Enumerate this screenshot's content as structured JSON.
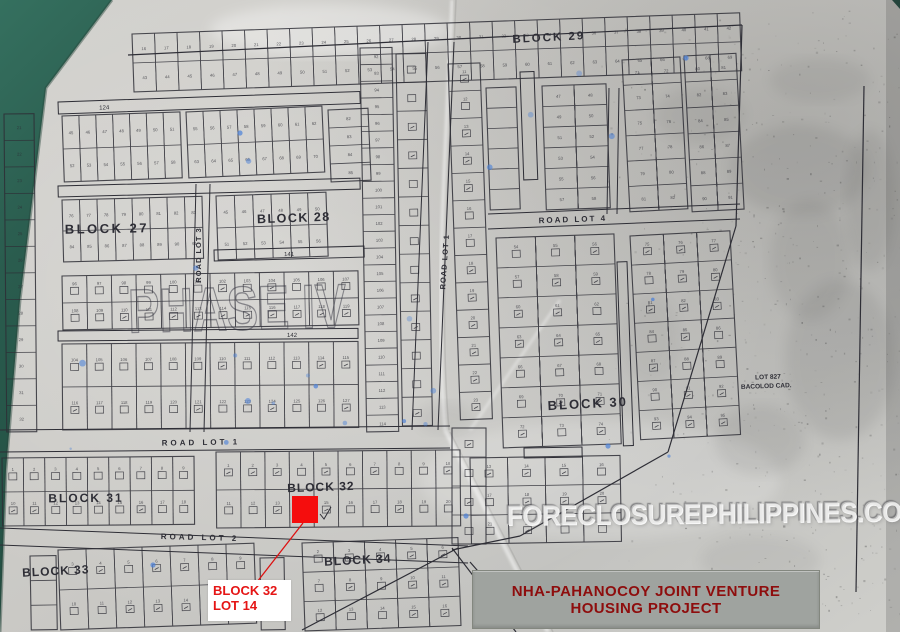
{
  "title_box": {
    "line1": "NHA-PAHANOCOY JOINT VENTURE",
    "line2": "HOUSING PROJECT"
  },
  "highlight_callout": {
    "line1": "BLOCK 32",
    "line2": "LOT 14"
  },
  "watermarks": {
    "site": "FORECLOSUREPHILIPPINES.COM",
    "phase": "PHASE IV"
  },
  "colors": {
    "background_cloth": "#235447",
    "paper": "#cccbc7",
    "ink": "#2e2e36",
    "highlight_red": "#f50d0d",
    "callout_red": "#e51515",
    "title_red": "#8e0d0d",
    "title_bg": "#9fa39f",
    "stain_blue": "#4a80d8"
  },
  "plat": {
    "block_labels": [
      {
        "text": "BLOCK 29",
        "x": 549,
        "y": 41,
        "size": 11.5,
        "rot": -3,
        "ls": 2
      },
      {
        "text": "BLOCK 27",
        "x": 107,
        "y": 233,
        "size": 13,
        "rot": -1,
        "ls": 2.5
      },
      {
        "text": "BLOCK 28",
        "x": 294,
        "y": 222,
        "size": 12.5,
        "rot": -2,
        "ls": 1.5
      },
      {
        "text": "BLOCK 30",
        "x": 588,
        "y": 408,
        "size": 13,
        "rot": -3,
        "ls": 2
      },
      {
        "text": "BLOCK 31",
        "x": 86,
        "y": 502,
        "size": 12,
        "rot": -0.5,
        "ls": 2
      },
      {
        "text": "BLOCK 32",
        "x": 321,
        "y": 491,
        "size": 12,
        "rot": -2,
        "ls": 1
      },
      {
        "text": "BLOCK 33",
        "x": 56,
        "y": 575,
        "size": 12,
        "rot": -3,
        "ls": 1
      },
      {
        "text": "BLOCK 34",
        "x": 358,
        "y": 564,
        "size": 12,
        "rot": -3,
        "ls": 1
      }
    ],
    "road_labels": [
      {
        "text": "ROAD LOT 3",
        "x": 201,
        "y": 255,
        "size": 7.5,
        "rot": -90,
        "ls": 1
      },
      {
        "text": "ROAD LOT 1",
        "x": 447,
        "y": 262,
        "size": 7.5,
        "rot": -86,
        "ls": 1
      },
      {
        "text": "ROAD LOT 4",
        "x": 573,
        "y": 222,
        "size": 8,
        "rot": -2,
        "ls": 2
      },
      {
        "text": "ROAD LOT 1",
        "x": 201,
        "y": 445,
        "size": 8,
        "rot": -1,
        "ls": 3
      },
      {
        "text": "ROAD LOT 2",
        "x": 200,
        "y": 540,
        "size": 8,
        "rot": 1.5,
        "ls": 3
      }
    ],
    "landmark": {
      "line1": "LOT 827",
      "line2": "BACOLOD CAD.",
      "x": 768,
      "y": 379
    },
    "grids": [
      {
        "x": 132,
        "y": 34,
        "w": 608,
        "h": 58,
        "rows": 2,
        "cols": 27,
        "rot": -2,
        "start": 16
      },
      {
        "x": 4,
        "y": 114,
        "w": 30,
        "h": 318,
        "rows": 12,
        "cols": 1,
        "rot": -0.5,
        "start": 21
      },
      {
        "x": 62,
        "y": 116,
        "w": 118,
        "h": 66,
        "rows": 2,
        "cols": 7,
        "rot": -2,
        "start": 45
      },
      {
        "x": 186,
        "y": 112,
        "w": 136,
        "h": 66,
        "rows": 2,
        "cols": 8,
        "rot": -2.5,
        "start": 55
      },
      {
        "x": 328,
        "y": 110,
        "w": 40,
        "h": 72,
        "rows": 4,
        "cols": 1,
        "rot": -2.5,
        "start": 82
      },
      {
        "x": 62,
        "y": 200,
        "w": 140,
        "h": 62,
        "rows": 2,
        "cols": 8,
        "rot": -1.5,
        "start": 76
      },
      {
        "x": 216,
        "y": 196,
        "w": 110,
        "h": 64,
        "rows": 2,
        "cols": 6,
        "rot": -2,
        "start": 45
      },
      {
        "x": 360,
        "y": 48,
        "w": 32,
        "h": 384,
        "rows": 23,
        "cols": 1,
        "rot": -1,
        "start": 92
      },
      {
        "x": 396,
        "y": 54,
        "w": 30,
        "h": 372,
        "rows": 13,
        "cols": 1,
        "rot": -1,
        "sym": true
      },
      {
        "x": 62,
        "y": 276,
        "w": 296,
        "h": 54,
        "rows": 2,
        "cols": 12,
        "rot": -1,
        "start": 96,
        "sym": true
      },
      {
        "x": 62,
        "y": 344,
        "w": 296,
        "h": 86,
        "rows": 2,
        "cols": 12,
        "rot": -0.5,
        "start": 104,
        "sym": true
      },
      {
        "x": 448,
        "y": 64,
        "w": 32,
        "h": 356,
        "rows": 13,
        "cols": 1,
        "rot": -2,
        "start": 11,
        "sym": true
      },
      {
        "x": 452,
        "y": 428,
        "w": 34,
        "h": 116,
        "rows": 4,
        "cols": 1,
        "rot": 0,
        "sym": true
      },
      {
        "x": 486,
        "y": 88,
        "w": 30,
        "h": 122,
        "rows": 6,
        "cols": 1,
        "rot": -2
      },
      {
        "x": 542,
        "y": 86,
        "w": 64,
        "h": 124,
        "rows": 6,
        "cols": 2,
        "rot": -2,
        "start": 47
      },
      {
        "x": 622,
        "y": 60,
        "w": 58,
        "h": 152,
        "rows": 6,
        "cols": 2,
        "rot": -3,
        "start": 71
      },
      {
        "x": 684,
        "y": 56,
        "w": 52,
        "h": 156,
        "rows": 6,
        "cols": 2,
        "rot": -3,
        "start": 80
      },
      {
        "x": 496,
        "y": 238,
        "w": 118,
        "h": 210,
        "rows": 7,
        "cols": 3,
        "rot": -2,
        "start": 54,
        "sym": true
      },
      {
        "x": 630,
        "y": 236,
        "w": 100,
        "h": 204,
        "rows": 7,
        "cols": 3,
        "rot": -3,
        "start": 75,
        "sym": true
      },
      {
        "x": 470,
        "y": 458,
        "w": 150,
        "h": 86,
        "rows": 3,
        "cols": 4,
        "rot": -1,
        "start": 13,
        "sym": true
      },
      {
        "x": 2,
        "y": 458,
        "w": 192,
        "h": 68,
        "rows": 2,
        "cols": 9,
        "rot": -0.5,
        "start": 1,
        "sym": true
      },
      {
        "x": 216,
        "y": 452,
        "w": 244,
        "h": 76,
        "rows": 2,
        "cols": 10,
        "rot": -0.5,
        "start": 1,
        "sym": true
      },
      {
        "x": 30,
        "y": 556,
        "w": 26,
        "h": 74,
        "rows": 3,
        "cols": 1,
        "rot": -1
      },
      {
        "x": 58,
        "y": 550,
        "w": 196,
        "h": 80,
        "rows": 2,
        "cols": 7,
        "rot": -2,
        "start": 3,
        "sym": true
      },
      {
        "x": 260,
        "y": 558,
        "w": 24,
        "h": 72,
        "rows": 3,
        "cols": 1,
        "rot": -1
      },
      {
        "x": 302,
        "y": 543,
        "w": 156,
        "h": 88,
        "rows": 3,
        "cols": 5,
        "rot": -2,
        "start": 2,
        "sym": true
      }
    ],
    "strips": [
      {
        "x": 58,
        "y": 102,
        "w": 302,
        "h": 12,
        "rot": -2,
        "label": "124",
        "lx": 104,
        "ly": 111
      },
      {
        "x": 58,
        "y": 186,
        "w": 302,
        "h": 11,
        "rot": -1.5
      },
      {
        "x": 214,
        "y": 250,
        "w": 150,
        "h": 11,
        "rot": -1.5,
        "label": "141",
        "lx": 289,
        "ly": 258
      },
      {
        "x": 58,
        "y": 331,
        "w": 300,
        "h": 10,
        "rot": -0.5,
        "label": "142",
        "lx": 292,
        "ly": 339
      },
      {
        "x": 520,
        "y": 72,
        "w": 14,
        "h": 108,
        "rot": -2
      },
      {
        "x": 617,
        "y": 262,
        "w": 10,
        "h": 184,
        "rot": -2
      },
      {
        "x": 524,
        "y": 448,
        "w": 58,
        "h": 10,
        "rot": -1
      }
    ],
    "roads": [
      {
        "x1": 196,
        "y1": 184,
        "x2": 190,
        "y2": 432,
        "dx": 14,
        "dy": 0
      },
      {
        "x1": 428,
        "y1": 42,
        "x2": 412,
        "y2": 430,
        "dx": 26,
        "dy": 0
      },
      {
        "x1": 488,
        "y1": 214,
        "x2": 740,
        "y2": 204,
        "dx": 0,
        "dy": 15
      },
      {
        "x1": 0,
        "y1": 430,
        "x2": 450,
        "y2": 426,
        "dx": 0,
        "dy": 22
      },
      {
        "x1": 0,
        "y1": 528,
        "x2": 468,
        "y2": 546,
        "dx": 0,
        "dy": 17
      },
      {
        "x1": 609,
        "y1": 88,
        "x2": 607,
        "y2": 214,
        "dx": 10,
        "dy": 0
      }
    ],
    "boundaries": [
      [
        128,
        55,
        742,
        25
      ],
      [
        742,
        25,
        736,
        226
      ],
      [
        736,
        226,
        668,
        452
      ],
      [
        668,
        452,
        520,
        536
      ],
      [
        520,
        536,
        452,
        550
      ],
      [
        452,
        548,
        516,
        632
      ],
      [
        470,
        562,
        526,
        626
      ],
      [
        302,
        630,
        458,
        548
      ],
      [
        864,
        86,
        856,
        592
      ]
    ],
    "highlight": {
      "x": 292,
      "y": 496,
      "w": 26,
      "h": 27
    },
    "leader": {
      "x1": 303,
      "y1": 523,
      "x2": 257,
      "y2": 582
    }
  }
}
